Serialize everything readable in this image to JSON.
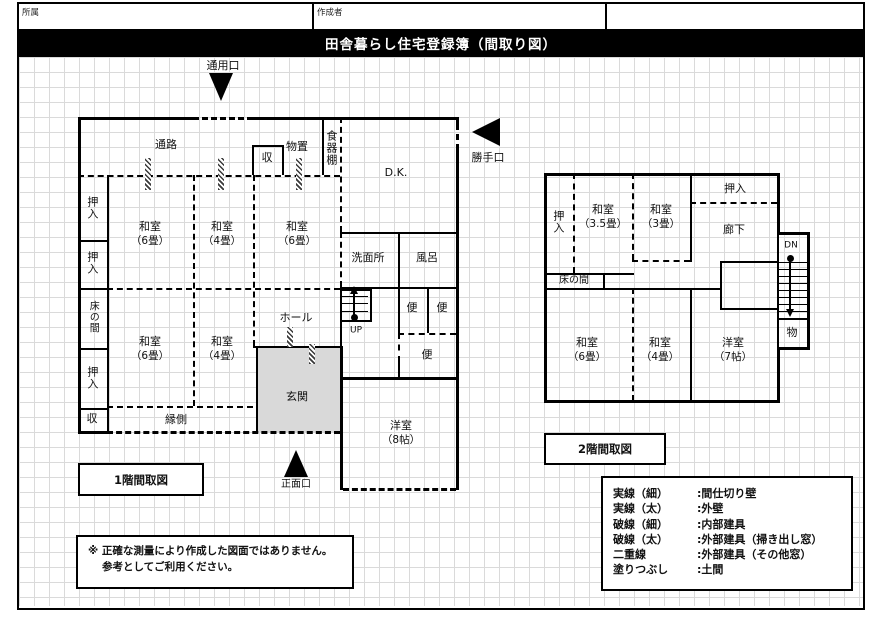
{
  "header": {
    "affiliation_label": "所属",
    "author_label": "作成者"
  },
  "title": "田舎暮らし住宅登録簿（間取り図）",
  "floor1": {
    "caption": "1階間取図",
    "entrance_top": "通用口",
    "entrance_side": "勝手口",
    "entrance_front": "正面口",
    "rooms": {
      "passage": "通路",
      "closet_top": "収",
      "storage_room": "物置",
      "cupboard": "食器棚",
      "dining_kitchen": "D.K.",
      "closet_1": "押入",
      "closet_2": "押入",
      "tokonoma": "床の間",
      "closet_3": "押入",
      "closet_bottom": "収",
      "washitsu_6_top": {
        "name": "和室",
        "size": "（6畳）"
      },
      "washitsu_4_top": {
        "name": "和室",
        "size": "（4畳）"
      },
      "washitsu_6_right": {
        "name": "和室",
        "size": "（6畳）"
      },
      "washitsu_6_bottom": {
        "name": "和室",
        "size": "（6畳）"
      },
      "washitsu_4_bottom": {
        "name": "和室",
        "size": "（4畳）"
      },
      "hall": "ホール",
      "genkan": "玄関",
      "engawa": "縁側",
      "washroom": "洗面所",
      "bath": "風呂",
      "toilet_1": "便",
      "toilet_2": "便",
      "toilet_3": "便",
      "stairs_up": "UP",
      "yoshitsu_8": {
        "name": "洋室",
        "size": "（8帖）"
      }
    }
  },
  "floor2": {
    "caption": "2階間取図",
    "rooms": {
      "closet_left": "押入",
      "washitsu_35": {
        "name": "和室",
        "size": "（3.5畳）"
      },
      "washitsu_3": {
        "name": "和室",
        "size": "（3畳）"
      },
      "closet_top": "押入",
      "corridor": "廊下",
      "tokonoma": "床の間",
      "stairs_down": "DN",
      "storage": "物",
      "washitsu_6": {
        "name": "和室",
        "size": "（6畳）"
      },
      "washitsu_4": {
        "name": "和室",
        "size": "（4畳）"
      },
      "yoshitsu_7": {
        "name": "洋室",
        "size": "（7帖）"
      }
    }
  },
  "legend": {
    "rows": [
      {
        "term": "実線（細）",
        "desc": ":間仕切り壁"
      },
      {
        "term": "実線（太）",
        "desc": ":外壁"
      },
      {
        "term": "破線（細）",
        "desc": ":内部建具"
      },
      {
        "term": "破線（太）",
        "desc": ":外部建具（掃き出し窓）"
      },
      {
        "term": "二重線",
        "desc": ":外部建具（その他窓）"
      },
      {
        "term": "塗りつぶし",
        "desc": ":土間"
      }
    ]
  },
  "note": {
    "line1": "※ 正確な測量により作成した図面ではありません。",
    "line2": "参考としてご利用ください。"
  }
}
